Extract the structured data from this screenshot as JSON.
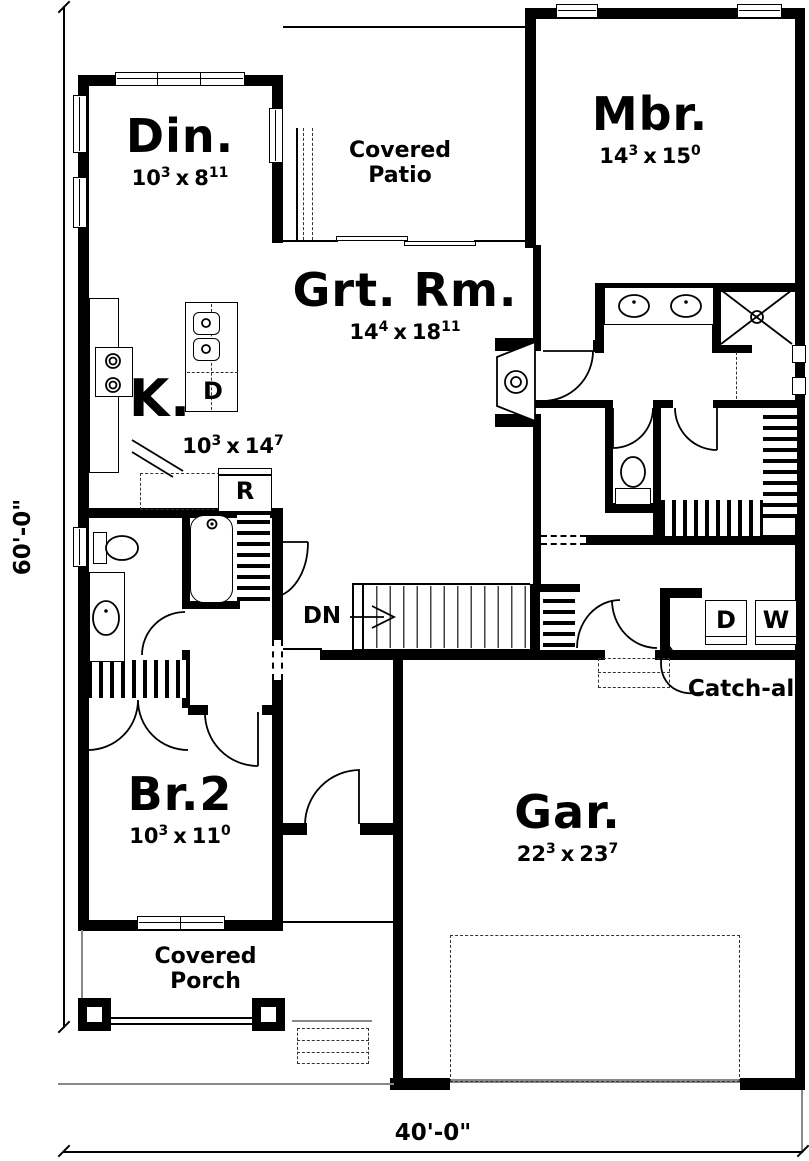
{
  "plan": {
    "rooms": {
      "dining": {
        "label": "Din.",
        "dim": {
          "a": "10",
          "as": "3",
          "x": "x",
          "b": "8",
          "bs": "11"
        }
      },
      "patio": {
        "line1": "Covered",
        "line2": "Patio"
      },
      "master": {
        "label": "Mbr.",
        "dim": {
          "a": "14",
          "as": "3",
          "x": "x",
          "b": "15",
          "bs": "0"
        }
      },
      "great": {
        "label": "Grt. Rm.",
        "dim": {
          "a": "14",
          "as": "4",
          "x": "x",
          "b": "18",
          "bs": "11"
        }
      },
      "kitchen": {
        "label": "K.",
        "dim": {
          "a": "10",
          "as": "3",
          "x": "x",
          "b": "14",
          "bs": "7"
        }
      },
      "bed2": {
        "label": "Br.2",
        "dim": {
          "a": "10",
          "as": "3",
          "x": "x",
          "b": "11",
          "bs": "0"
        }
      },
      "garage": {
        "label": "Gar.",
        "dim": {
          "a": "22",
          "as": "3",
          "x": "x",
          "b": "23",
          "bs": "7"
        }
      },
      "porch": {
        "line1": "Covered",
        "line2": "Porch"
      }
    },
    "labels": {
      "stairs_down": "DN",
      "catchall": "Catch-all",
      "island_dishwasher": "D",
      "range": "R",
      "dryer": "D",
      "washer": "W"
    },
    "dimensions": {
      "width": "40'-0\"",
      "height": "60'-0\""
    },
    "colors": {
      "ink": "#000000",
      "soft": "#888888"
    }
  }
}
